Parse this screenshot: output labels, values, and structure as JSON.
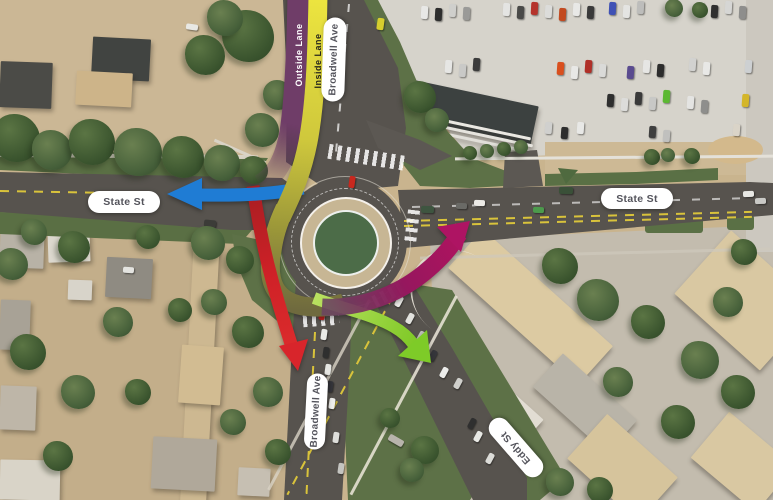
{
  "title": "Aerial rendering of Broadwell Ave / State St / Eddy St roundabout with traffic-flow arrows",
  "lane_ribbons": {
    "outside": "Outside Lane",
    "inside": "Inside Lane"
  },
  "street_pills": {
    "broadwell_top": "Broadwell Ave",
    "state_west": "State St",
    "state_east": "State St",
    "broadwell_bottom": "Broadwell Ave",
    "eddy": "Eddy St"
  },
  "arrow_colors": {
    "outside_lane_purple": "#6f3d68",
    "inside_lane_yellow": "#ece43f",
    "inside_lane_olive_fade": "#6f6a3e",
    "west_exit_blue": "#1f7cd4",
    "south_exit_red": "#d2242a",
    "east_exit_magenta": "#ae1463",
    "southeast_exit_green": "#7ecb28"
  },
  "map_colors": {
    "asphalt": "#57534e",
    "grass": "#5d7147",
    "truck_apron": "#c7b694",
    "center_island_green": "#4c6c48",
    "parking_lot": "#d6d3cb",
    "sand": "#cbb795",
    "concrete": "#c3bcae"
  },
  "scene": {
    "buildings": [
      [
        200,
        370,
        26,
        265,
        3,
        "#cdb891"
      ],
      [
        26,
        85,
        52,
        46,
        2,
        "#4b4b47"
      ],
      [
        121,
        59,
        58,
        42,
        3,
        "#414441"
      ],
      [
        104,
        89,
        56,
        34,
        3,
        "#cdb489"
      ],
      [
        22,
        248,
        44,
        40,
        2,
        "#b8b2a6"
      ],
      [
        69,
        247,
        42,
        30,
        -2,
        "#dcd8ce"
      ],
      [
        15,
        325,
        30,
        50,
        2,
        "#a8a296"
      ],
      [
        129,
        278,
        46,
        40,
        3,
        "#8f8b82"
      ],
      [
        80,
        290,
        24,
        20,
        2,
        "#d8d4ca"
      ],
      [
        201,
        375,
        42,
        58,
        4,
        "#d2bc92"
      ],
      [
        184,
        464,
        64,
        52,
        3,
        "#b0a89a"
      ],
      [
        254,
        482,
        32,
        28,
        3,
        "#c6bfb2"
      ],
      [
        18,
        408,
        36,
        44,
        2,
        "#beb6a8"
      ],
      [
        30,
        480,
        60,
        40,
        1,
        "#d9d4c8"
      ],
      [
        530,
        307,
        175,
        52,
        42,
        "#dccaa2"
      ],
      [
        745,
        300,
        115,
        85,
        42,
        "#d9c8a2"
      ],
      [
        585,
        403,
        100,
        45,
        42,
        "#b9b4a8"
      ],
      [
        622,
        468,
        95,
        60,
        42,
        "#d6c49c"
      ],
      [
        742,
        462,
        85,
        60,
        40,
        "#d9c8a2"
      ],
      [
        520,
        416,
        40,
        26,
        42,
        "#e2ddd3"
      ],
      [
        468,
        112,
        135,
        40,
        12,
        "#3c4140"
      ],
      [
        472,
        126,
        120,
        3,
        12,
        "#eae8e2"
      ],
      [
        474,
        133,
        120,
        3,
        12,
        "#e6e4de"
      ],
      [
        476,
        140,
        120,
        3,
        12,
        "#e1dfd9"
      ]
    ],
    "trees": [
      [
        16,
        138,
        24,
        0
      ],
      [
        52,
        150,
        20,
        1
      ],
      [
        92,
        142,
        23,
        0
      ],
      [
        138,
        152,
        24,
        1
      ],
      [
        183,
        157,
        21,
        0
      ],
      [
        222,
        163,
        18,
        1
      ],
      [
        254,
        170,
        14,
        0
      ],
      [
        262,
        130,
        17,
        1
      ],
      [
        248,
        36,
        26,
        0
      ],
      [
        278,
        95,
        15,
        1
      ],
      [
        225,
        18,
        18,
        1
      ],
      [
        205,
        55,
        20,
        0
      ],
      [
        34,
        232,
        13,
        1
      ],
      [
        74,
        247,
        16,
        0
      ],
      [
        12,
        264,
        16,
        1
      ],
      [
        148,
        237,
        12,
        0
      ],
      [
        208,
        243,
        17,
        1
      ],
      [
        240,
        260,
        14,
        0
      ],
      [
        118,
        322,
        15,
        1
      ],
      [
        28,
        352,
        18,
        0
      ],
      [
        78,
        392,
        17,
        1
      ],
      [
        138,
        392,
        13,
        0
      ],
      [
        214,
        302,
        13,
        1
      ],
      [
        248,
        332,
        16,
        0
      ],
      [
        268,
        392,
        15,
        1
      ],
      [
        58,
        456,
        15,
        0
      ],
      [
        233,
        422,
        13,
        1
      ],
      [
        278,
        452,
        13,
        0
      ],
      [
        180,
        310,
        12,
        0
      ],
      [
        420,
        97,
        16,
        0
      ],
      [
        437,
        120,
        12,
        1
      ],
      [
        470,
        153,
        7,
        0
      ],
      [
        487,
        151,
        7,
        1
      ],
      [
        504,
        149,
        7,
        0
      ],
      [
        521,
        147,
        7,
        1
      ],
      [
        652,
        157,
        8,
        0
      ],
      [
        668,
        155,
        7,
        1
      ],
      [
        692,
        156,
        8,
        0
      ],
      [
        674,
        8,
        9,
        1
      ],
      [
        700,
        10,
        8,
        0
      ],
      [
        560,
        266,
        18,
        0
      ],
      [
        598,
        300,
        21,
        1
      ],
      [
        648,
        322,
        17,
        0
      ],
      [
        700,
        360,
        19,
        1
      ],
      [
        738,
        392,
        17,
        0
      ],
      [
        618,
        382,
        15,
        1
      ],
      [
        678,
        422,
        17,
        0
      ],
      [
        728,
        302,
        15,
        1
      ],
      [
        744,
        252,
        13,
        0
      ],
      [
        560,
        482,
        14,
        1
      ],
      [
        600,
        490,
        13,
        0
      ],
      [
        425,
        450,
        14,
        0
      ],
      [
        412,
        470,
        12,
        1
      ],
      [
        390,
        418,
        10,
        0
      ]
    ],
    "cars": [
      [
        424,
        12,
        7,
        13,
        3,
        "#e8e8e6"
      ],
      [
        438,
        14,
        7,
        13,
        3,
        "#2e2e2e"
      ],
      [
        452,
        10,
        7,
        13,
        3,
        "#cfcfcc"
      ],
      [
        466,
        13,
        7,
        13,
        3,
        "#9a9a98"
      ],
      [
        506,
        9,
        7,
        13,
        3,
        "#e4e4e2"
      ],
      [
        520,
        12,
        7,
        13,
        3,
        "#4a4a48"
      ],
      [
        534,
        8,
        7,
        13,
        3,
        "#b5342c"
      ],
      [
        548,
        11,
        7,
        13,
        3,
        "#dcdcda"
      ],
      [
        562,
        14,
        7,
        13,
        3,
        "#c24a20"
      ],
      [
        576,
        9,
        7,
        13,
        3,
        "#e8e8e6"
      ],
      [
        590,
        12,
        7,
        13,
        3,
        "#3a3a3a"
      ],
      [
        612,
        8,
        7,
        13,
        3,
        "#3f51b5"
      ],
      [
        626,
        11,
        7,
        13,
        3,
        "#e4e4e2"
      ],
      [
        640,
        7,
        7,
        13,
        3,
        "#bdbdbb"
      ],
      [
        700,
        8,
        7,
        13,
        3,
        "#e8e8e6"
      ],
      [
        714,
        11,
        7,
        13,
        3,
        "#2f2f2f"
      ],
      [
        728,
        7,
        7,
        13,
        3,
        "#d6d6d4"
      ],
      [
        742,
        12,
        7,
        13,
        3,
        "#8e8e8c"
      ],
      [
        448,
        66,
        7,
        13,
        4,
        "#e6e6e4"
      ],
      [
        462,
        70,
        7,
        13,
        4,
        "#c9c9c7"
      ],
      [
        476,
        64,
        7,
        13,
        4,
        "#3b3b3b"
      ],
      [
        560,
        68,
        7,
        13,
        4,
        "#d94f1e"
      ],
      [
        574,
        72,
        7,
        13,
        4,
        "#e8e8e6"
      ],
      [
        588,
        66,
        7,
        13,
        4,
        "#b03028"
      ],
      [
        602,
        70,
        7,
        13,
        4,
        "#dadad8"
      ],
      [
        630,
        72,
        7,
        13,
        4,
        "#5a4b8f"
      ],
      [
        646,
        66,
        7,
        13,
        4,
        "#e6e6e4"
      ],
      [
        660,
        70,
        7,
        13,
        4,
        "#2d2d2d"
      ],
      [
        692,
        64,
        7,
        13,
        4,
        "#d2d2d0"
      ],
      [
        706,
        68,
        7,
        13,
        4,
        "#e8e8e6"
      ],
      [
        748,
        66,
        7,
        13,
        4,
        "#cdd0d2"
      ],
      [
        610,
        100,
        7,
        13,
        4,
        "#2f2f2f"
      ],
      [
        624,
        104,
        7,
        13,
        4,
        "#dcdcda"
      ],
      [
        638,
        98,
        7,
        13,
        4,
        "#3a3a3a"
      ],
      [
        652,
        103,
        7,
        13,
        4,
        "#c8c8c6"
      ],
      [
        666,
        96,
        7,
        13,
        4,
        "#5cb832"
      ],
      [
        690,
        102,
        7,
        13,
        4,
        "#e4e4e2"
      ],
      [
        704,
        106,
        7,
        13,
        4,
        "#8e8e8c"
      ],
      [
        745,
        100,
        7,
        13,
        4,
        "#d4b62a"
      ],
      [
        548,
        128,
        7,
        12,
        4,
        "#d0d0ce"
      ],
      [
        564,
        133,
        7,
        12,
        4,
        "#2d2d2d"
      ],
      [
        580,
        128,
        7,
        12,
        4,
        "#e8e8e6"
      ],
      [
        652,
        132,
        7,
        12,
        4,
        "#3f3f3f"
      ],
      [
        666,
        136,
        7,
        12,
        4,
        "#c0c0be"
      ],
      [
        736,
        130,
        7,
        12,
        4,
        "#dad4c8"
      ],
      [
        380,
        24,
        7,
        12,
        8,
        "#d6ce2e"
      ],
      [
        192,
        27,
        12,
        6,
        8,
        "#e8e8e4"
      ],
      [
        352,
        182,
        6,
        12,
        8,
        "#c8281e"
      ],
      [
        427,
        209,
        13,
        7,
        2,
        "#3e5540"
      ],
      [
        461,
        206,
        11,
        6,
        2,
        "#6a6a66"
      ],
      [
        479,
        203,
        11,
        6,
        2,
        "#eceae6"
      ],
      [
        538,
        210,
        11,
        6,
        2,
        "#4c9a4c"
      ],
      [
        566,
        190,
        14,
        7,
        2,
        "#3a5038"
      ],
      [
        748,
        194,
        11,
        6,
        -2,
        "#e8e8e4"
      ],
      [
        760,
        201,
        11,
        6,
        -2,
        "#c9c9c5"
      ],
      [
        210,
        223,
        12,
        7,
        6,
        "#3c3c38"
      ],
      [
        322,
        314,
        6,
        11,
        8,
        "#c02020"
      ],
      [
        324,
        334,
        6,
        11,
        8,
        "#ebebe7"
      ],
      [
        326,
        352,
        6,
        11,
        8,
        "#2f2f2f"
      ],
      [
        328,
        369,
        6,
        11,
        8,
        "#e6e6e2"
      ],
      [
        330,
        386,
        6,
        11,
        8,
        "#35353a"
      ],
      [
        332,
        403,
        6,
        11,
        8,
        "#eeeeea"
      ],
      [
        336,
        437,
        6,
        11,
        8,
        "#dededa"
      ],
      [
        341,
        468,
        6,
        11,
        8,
        "#c4c4c0"
      ],
      [
        399,
        301,
        6,
        11,
        28,
        "#ebebe7"
      ],
      [
        410,
        318,
        6,
        11,
        28,
        "#e2e2de"
      ],
      [
        421,
        336,
        6,
        11,
        28,
        "#bfbfbb"
      ],
      [
        433,
        355,
        6,
        11,
        28,
        "#35353a"
      ],
      [
        444,
        372,
        6,
        11,
        28,
        "#ececea"
      ],
      [
        458,
        383,
        6,
        11,
        28,
        "#d0d0cc"
      ],
      [
        472,
        423,
        6,
        11,
        28,
        "#2f2f2f"
      ],
      [
        478,
        436,
        6,
        11,
        28,
        "#e8e8e4"
      ],
      [
        490,
        458,
        6,
        11,
        28,
        "#dcdcd8"
      ],
      [
        128,
        270,
        11,
        6,
        4,
        "#e4e4e0"
      ],
      [
        396,
        440,
        16,
        7,
        30,
        "#b8b4ac"
      ]
    ]
  }
}
